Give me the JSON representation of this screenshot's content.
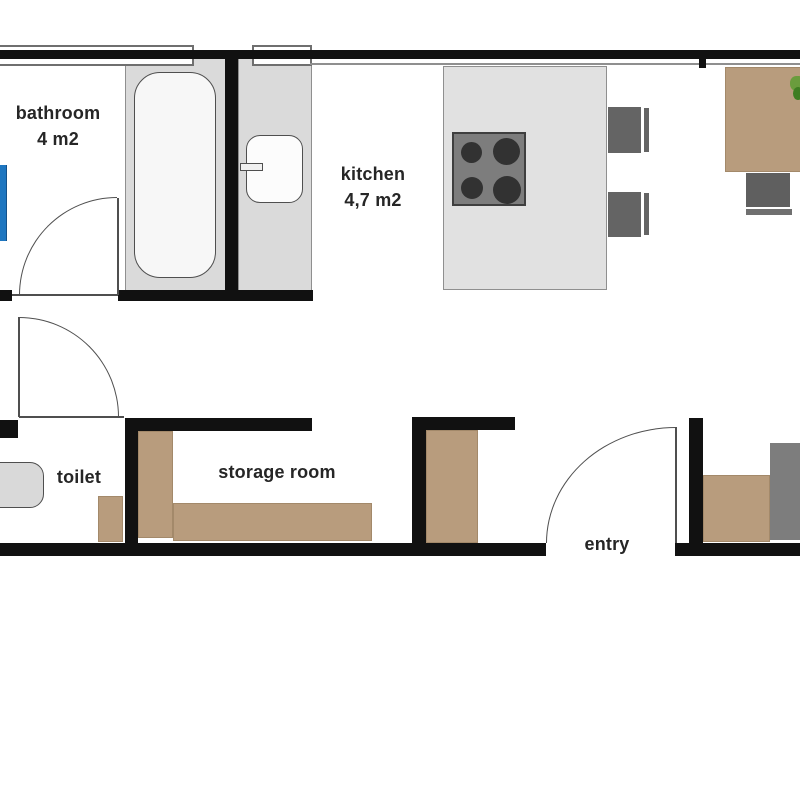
{
  "labels": {
    "bathroom": {
      "name": "bathroom",
      "area": "4 m2"
    },
    "kitchen": {
      "name": "kitchen",
      "area": "4,7 m2"
    },
    "toilet": "toilet",
    "storage": "storage room",
    "entry": "entry"
  },
  "palette": {
    "wall": "#111111",
    "line": "#4f4f4f",
    "surround": "#dadada",
    "counter": "#e1e1e1",
    "fixture": "#f7f7f7",
    "fixture-border": "#4f4f4f",
    "tan": "#b89c7d",
    "tan-border": "#a3896a",
    "dark": "#646464",
    "chair-bar": "#707070",
    "entry-gray": "#7d7d7d",
    "stove": "#7d7d7d",
    "stove-border": "#3f3f3f",
    "burner": "#323232",
    "blue": "#1e76c0",
    "blue-border": "#14518a",
    "text": "#262626",
    "border-gray": "#8f8f8f",
    "window-border": "#6f6f6f",
    "plant": "#6a9c3d",
    "plant-dark": "#3e7d22"
  }
}
